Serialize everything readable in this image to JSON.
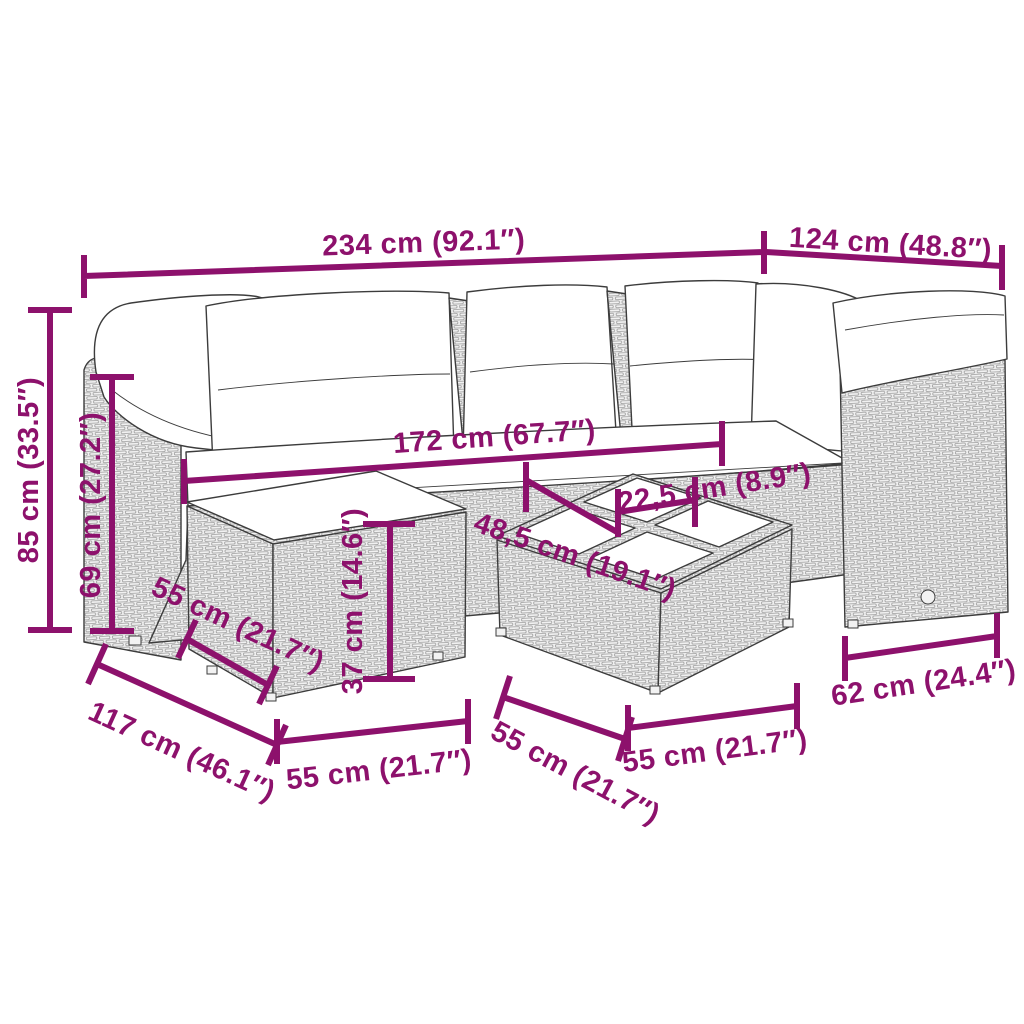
{
  "diagram": {
    "type": "product-dimension-diagram",
    "subject": "7-piece poly rattan garden lounge set with cushions (corner sofa, footstool, coffee table with glass tiles)",
    "accent_color": "#8D116C",
    "art_line_color": "#3C3C3C",
    "rattan_fill_color": "#F1F1F1",
    "cushion_color": "#FFFFFF",
    "dimensions": [
      {
        "id": "total-width",
        "label": "234 cm (92.1″)"
      },
      {
        "id": "right-side-width",
        "label": "124 cm (48.8″)"
      },
      {
        "id": "total-height",
        "label": "85 cm (33.5″)"
      },
      {
        "id": "backrest-height",
        "label": "69 cm (27.2″)"
      },
      {
        "id": "seating-width",
        "label": "172 cm (67.7″)"
      },
      {
        "id": "glass-tile-width",
        "label": "22,5 cm (8.9″)"
      },
      {
        "id": "seat-depth",
        "label": "48,5 cm (19.1″)"
      },
      {
        "id": "footstool-height",
        "label": "37 cm (14.6″)"
      },
      {
        "id": "corner-depth",
        "label": "117 cm (46.1″)"
      },
      {
        "id": "footstool-depth",
        "label": "55 cm (21.7″)"
      },
      {
        "id": "footstool-width",
        "label": "55 cm (21.7″)"
      },
      {
        "id": "table-depth",
        "label": "55 cm (21.7″)"
      },
      {
        "id": "table-width",
        "label": "55 cm (21.7″)"
      },
      {
        "id": "right-module-width",
        "label": "62 cm (24.4″)"
      }
    ]
  }
}
